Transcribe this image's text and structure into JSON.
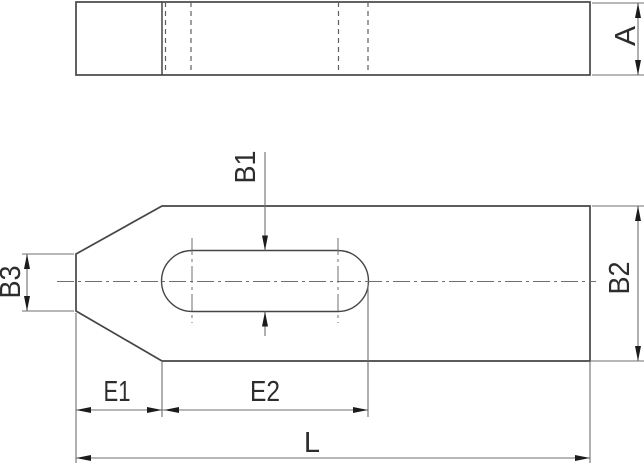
{
  "colors": {
    "background": "#ffffff",
    "outline": "#464646",
    "dimension": "#6f6f6f",
    "hidden": "#5f5f5f",
    "arrow": "#1c1c1c",
    "text": "#2d2d2d"
  },
  "views": {
    "side_view": {
      "thickness_label": "A"
    },
    "plan_view": {
      "slot_width_label": "B1",
      "overall_width_label": "B2",
      "tip_width_label": "B3",
      "edge_to_slot_label": "E1",
      "slot_length_label": "E2",
      "overall_length_label": "L"
    }
  }
}
